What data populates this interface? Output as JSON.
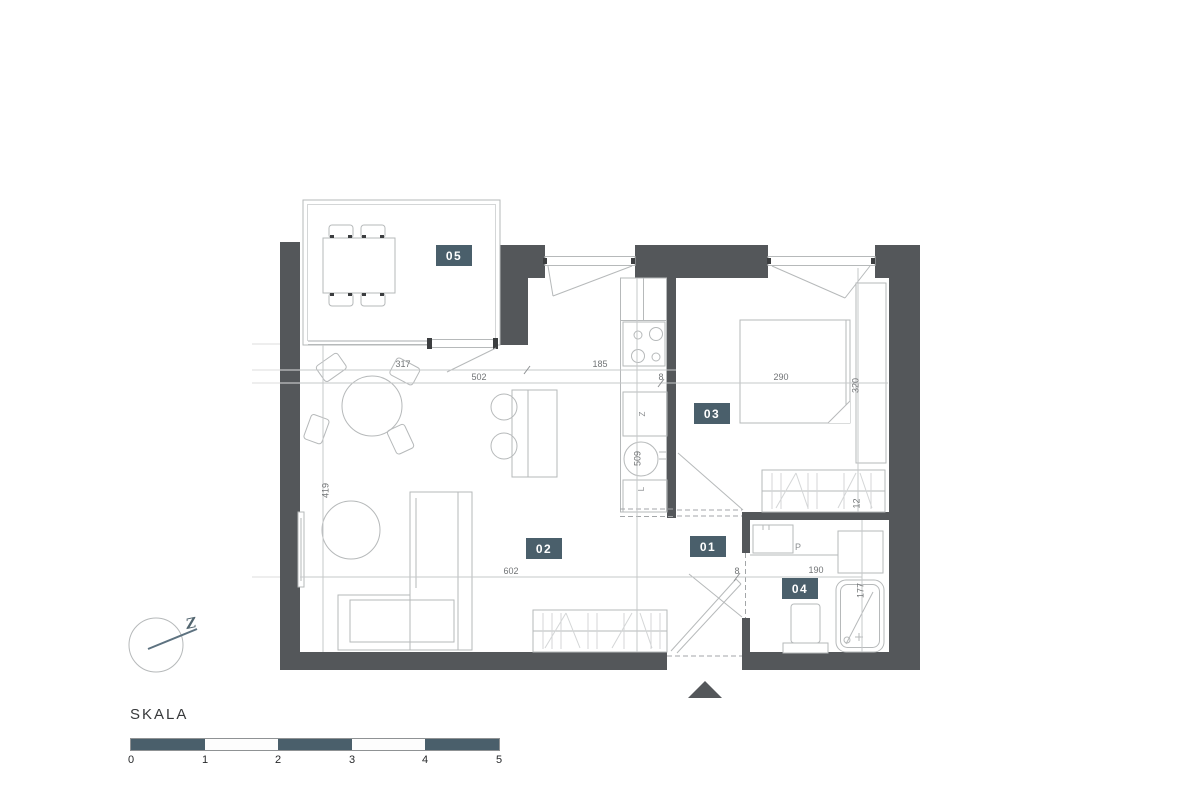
{
  "plan": {
    "rooms": [
      {
        "label": "05"
      },
      {
        "label": "03"
      },
      {
        "label": "02"
      },
      {
        "label": "01"
      },
      {
        "label": "04"
      }
    ],
    "dimensions": {
      "d317": "317",
      "d502": "502",
      "d185": "185",
      "d8_kitchen": "8",
      "d290": "290",
      "d320": "320",
      "d419": "419",
      "d509": "509",
      "d602": "602",
      "d8_hall": "8",
      "d190": "190",
      "d177": "177",
      "d12": "12"
    },
    "appliance_labels": {
      "dishwasher": "Z",
      "fridge": "L",
      "washing_machine": "P"
    },
    "compass_label": "Z"
  },
  "scale_bar": {
    "title": "SKALA",
    "ticks": [
      "0",
      "1",
      "2",
      "3",
      "4",
      "5"
    ]
  },
  "colors": {
    "wall": "#54575a",
    "accent": "#4a5f6b",
    "line": "#b6b9ba",
    "dim_line": "#c6c8c9",
    "dim_text": "#717476",
    "dark_mark": "#3c3e40"
  }
}
